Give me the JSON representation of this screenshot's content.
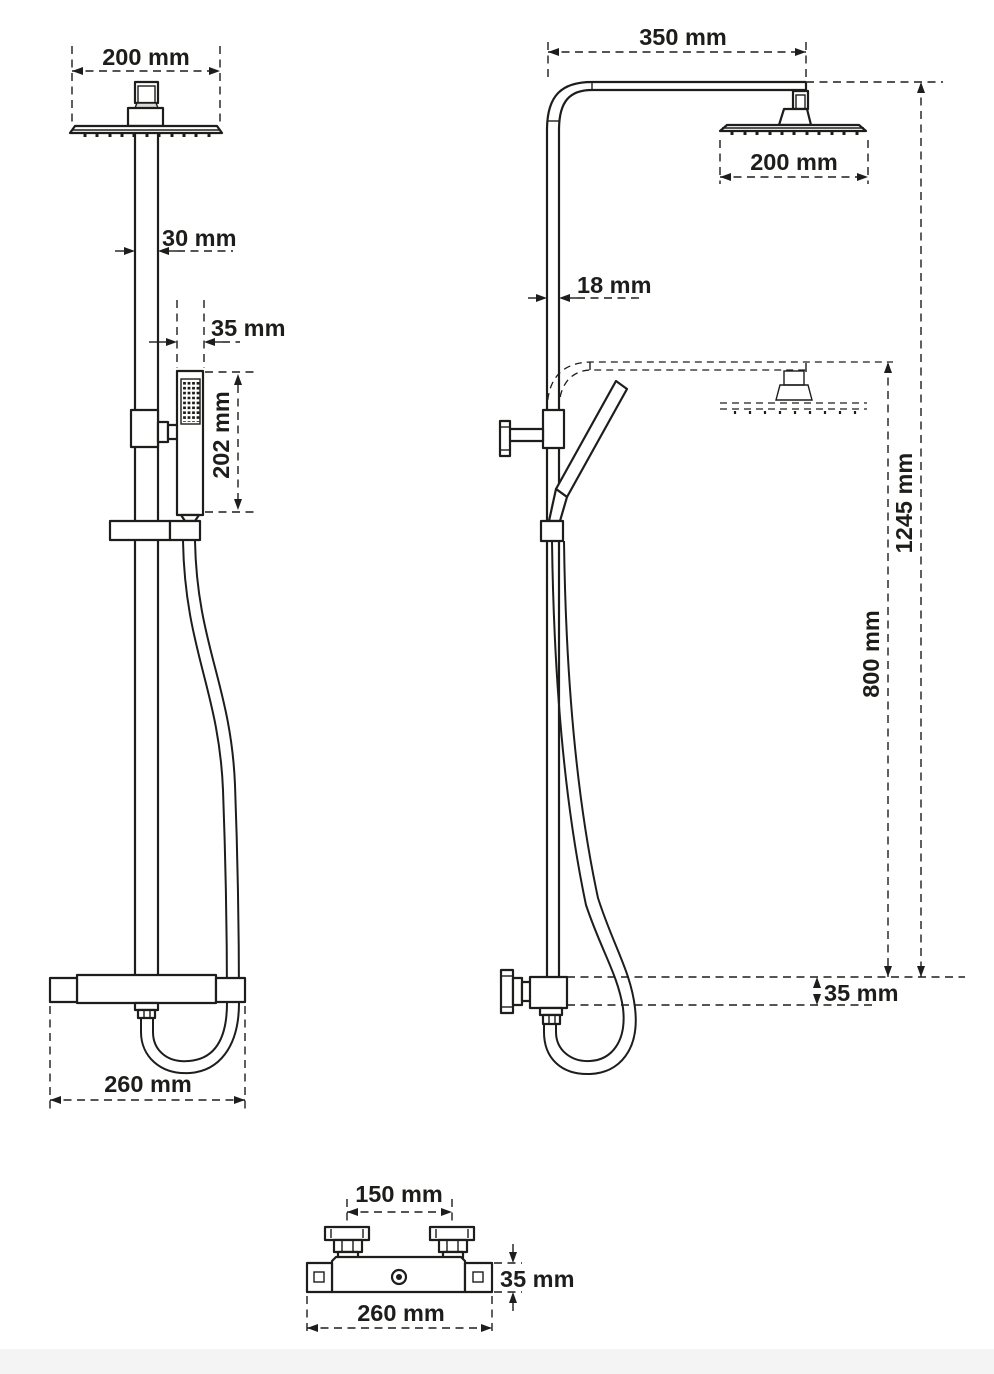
{
  "colors": {
    "line": "#1d1d1b",
    "background": "#ffffff",
    "page_edge": "#f4f4f4"
  },
  "views": {
    "front": {
      "dims": {
        "head_width": "200 mm",
        "pole_width": "30 mm",
        "handset_width": "35 mm",
        "handset_length": "202 mm",
        "mixer_width": "260 mm"
      }
    },
    "side": {
      "dims": {
        "arm_projection": "350 mm",
        "head_depth": "200 mm",
        "pole_depth": "18 mm",
        "height_max": "1245 mm",
        "height_min": "800 mm",
        "mixer_height": "35 mm"
      }
    },
    "bottom": {
      "dims": {
        "handle_spacing": "150 mm",
        "body_height": "35 mm",
        "mixer_width": "260 mm"
      }
    }
  }
}
